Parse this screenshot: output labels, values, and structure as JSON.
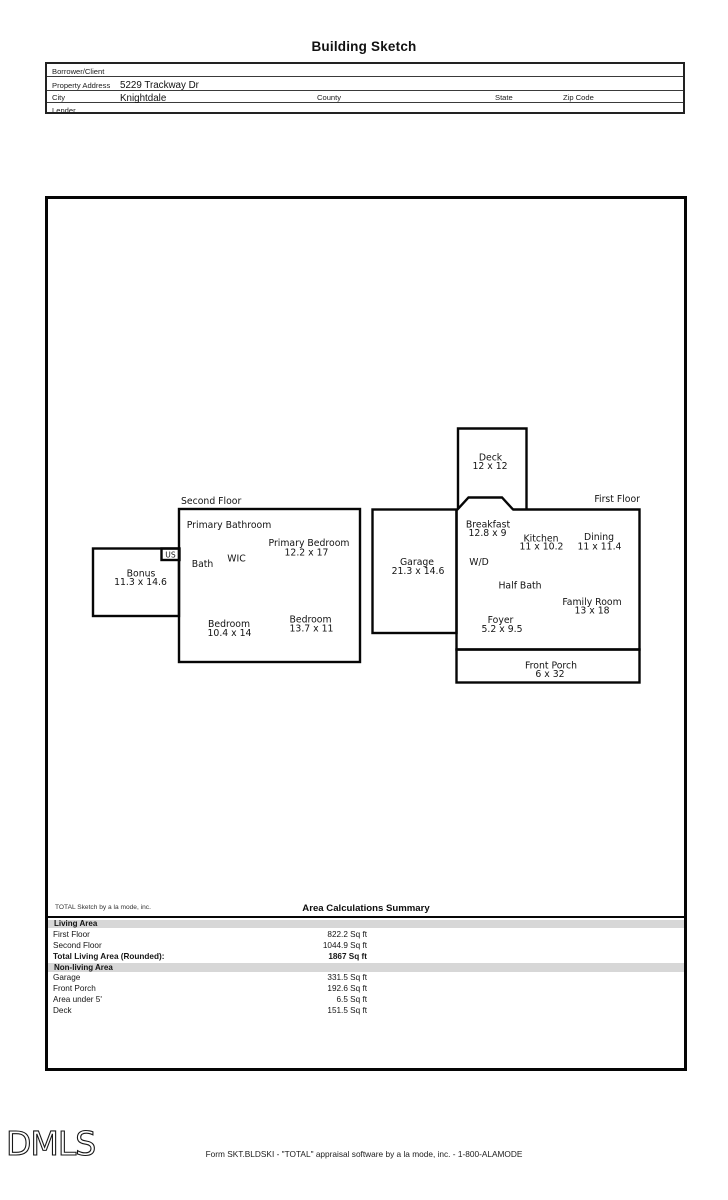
{
  "page": {
    "title": "Building Sketch",
    "footer": {
      "logo": "DMLS",
      "form_line": "Form SKT.BLDSKI - \"TOTAL\" appraisal software by a la mode, inc. - 1-800-ALAMODE"
    }
  },
  "form": {
    "borrower_label": "Borrower/Client",
    "borrower_value": "",
    "property_label": "Property Address",
    "property_value": "5229 Trackway Dr",
    "city_label": "City",
    "city_value": "Knightdale",
    "county_label": "County",
    "state_label": "State",
    "zip_label": "Zip Code",
    "lender_label": "Lender",
    "lender_value": ""
  },
  "sketch": {
    "second_floor": {
      "title": "Second Floor",
      "rooms": {
        "primary_bathroom": {
          "name": "Primary Bathroom"
        },
        "primary_bedroom": {
          "name": "Primary Bedroom",
          "dims": "12.2 x 17"
        },
        "bath": {
          "name": "Bath"
        },
        "wic": {
          "name": "WIC"
        },
        "stairs": {
          "name": "US"
        },
        "bonus": {
          "name": "Bonus",
          "dims": "11.3 x 14.6"
        },
        "bedroom_left": {
          "name": "Bedroom",
          "dims": "10.4 x 14"
        },
        "bedroom_right": {
          "name": "Bedroom",
          "dims": "13.7 x 11"
        }
      }
    },
    "first_floor": {
      "title": "First Floor",
      "rooms": {
        "deck": {
          "name": "Deck",
          "dims": "12 x 12"
        },
        "breakfast": {
          "name": "Breakfast",
          "dims": "12.8 x 9"
        },
        "kitchen": {
          "name": "Kitchen",
          "dims": "11 x 10.2"
        },
        "dining": {
          "name": "Dining",
          "dims": "11 x 11.4"
        },
        "wd": {
          "name": "W/D"
        },
        "garage": {
          "name": "Garage",
          "dims": "21.3 x 14.6"
        },
        "half_bath": {
          "name": "Half Bath"
        },
        "family_room": {
          "name": "Family Room",
          "dims": "13 x 18"
        },
        "foyer": {
          "name": "Foyer",
          "dims": "5.2 x 9.5"
        },
        "front_porch": {
          "name": "Front Porch",
          "dims": "6 x 32"
        }
      }
    }
  },
  "summary": {
    "attribution": "TOTAL Sketch by a la mode, inc.",
    "title": "Area Calculations Summary",
    "living": {
      "header": "Living Area",
      "rows": [
        {
          "label": "First Floor",
          "value": "822.2 Sq ft"
        },
        {
          "label": "Second Floor",
          "value": "1044.9 Sq ft"
        },
        {
          "label": "Total Living Area (Rounded):",
          "value": "1867 Sq ft"
        }
      ]
    },
    "nonliving": {
      "header": "Non-living Area",
      "rows": [
        {
          "label": "Garage",
          "value": "331.5 Sq ft"
        },
        {
          "label": "Front Porch",
          "value": "192.6 Sq ft"
        },
        {
          "label": "Area under 5'",
          "value": "6.5 Sq ft"
        },
        {
          "label": "Deck",
          "value": "151.5 Sq ft"
        }
      ]
    }
  }
}
